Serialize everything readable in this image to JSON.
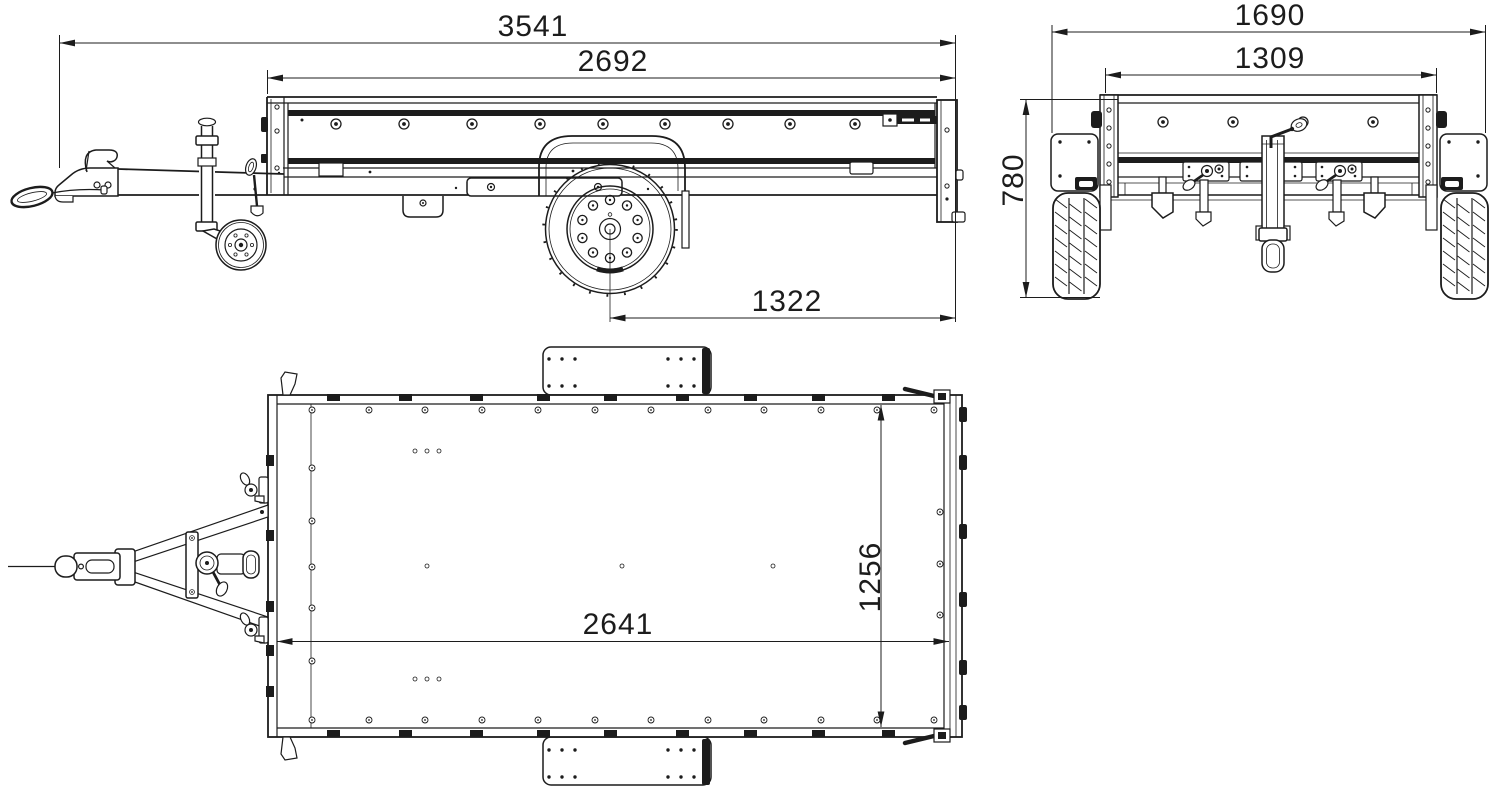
{
  "drawing": {
    "colors": {
      "line": "#1c1c1c",
      "background": "#ffffff"
    },
    "views": {
      "side": {
        "dimensions": {
          "overall_length": "3541",
          "box_length": "2692",
          "axle_to_rear": "1322"
        }
      },
      "front": {
        "dimensions": {
          "overall_width": "1690",
          "box_width": "1309",
          "height": "780"
        }
      },
      "top": {
        "dimensions": {
          "bed_length": "2641",
          "bed_width": "1256"
        }
      }
    }
  }
}
